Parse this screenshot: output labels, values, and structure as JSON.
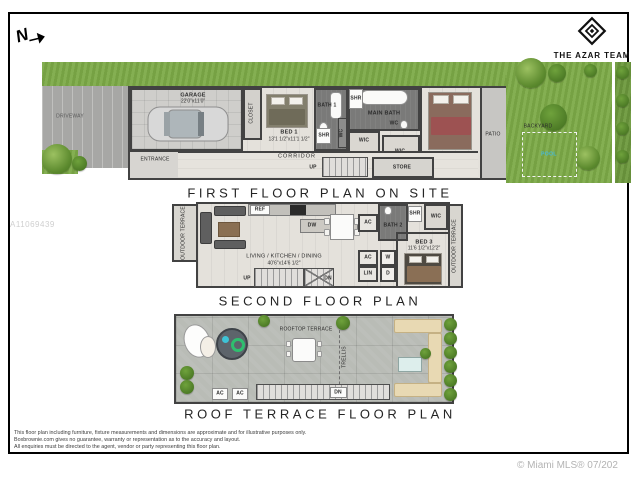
{
  "page": {
    "north": "N",
    "brand": "THE AZAR TEAM",
    "watermark": "A11069439",
    "copyright": "© Miami MLS® 07/202",
    "disclaimer_lines": [
      "This floor plan including furniture, fixture measurements and dimensions are approximate and for illustrative purposes only.",
      "Boxbrownie.com gives no guarantee, warranty or representation as to the accuracy and layout.",
      "All enquiries must be directed to the agent, vendor or party representing this floor plan."
    ]
  },
  "labels": {
    "wic": "WIC",
    "shr": "SHR",
    "wc": "WC",
    "ac": "AC",
    "up": "UP",
    "dn": "DN",
    "w": "W",
    "d": "D",
    "lin": "LIN",
    "ref": "REF",
    "dw": "DW",
    "outdoor_terrace": "OUTDOOR TERRACE"
  },
  "first_floor": {
    "title": "FIRST FLOOR PLAN ON SITE",
    "driveway": "DRIVEWAY",
    "entrance": "ENTRANCE",
    "closet": "CLOSET",
    "garage_name": "GARAGE",
    "garage_dims": "22'0\"x11'0\"",
    "bed1_name": "BED 1",
    "bed1_dims": "13'1 1/2\"x11'1 1/2\"",
    "bath1": "BATH 1",
    "main_bath": "MAIN BATH",
    "corridor": "CORRIDOR",
    "store": "STORE",
    "main_bed_name": "MAIN BED",
    "main_bed_dims": "12'2\"x18'11\"",
    "patio": "PATIO",
    "backyard": "BACKYARD",
    "pool": "POOL"
  },
  "second_floor": {
    "title": "SECOND FLOOR PLAN",
    "living_name": "LIVING / KITCHEN / DINING",
    "living_dims": "40'6\"x14'6 1/2\"",
    "bath2": "BATH 2",
    "bed3_name": "BED 3",
    "bed3_dims": "11'6 1/2\"x12'2\""
  },
  "roof": {
    "title": "ROOF TERRACE FLOOR PLAN",
    "rooftop_terrace": "ROOFTOP TERRACE",
    "trellis": "TRELLIS"
  }
}
